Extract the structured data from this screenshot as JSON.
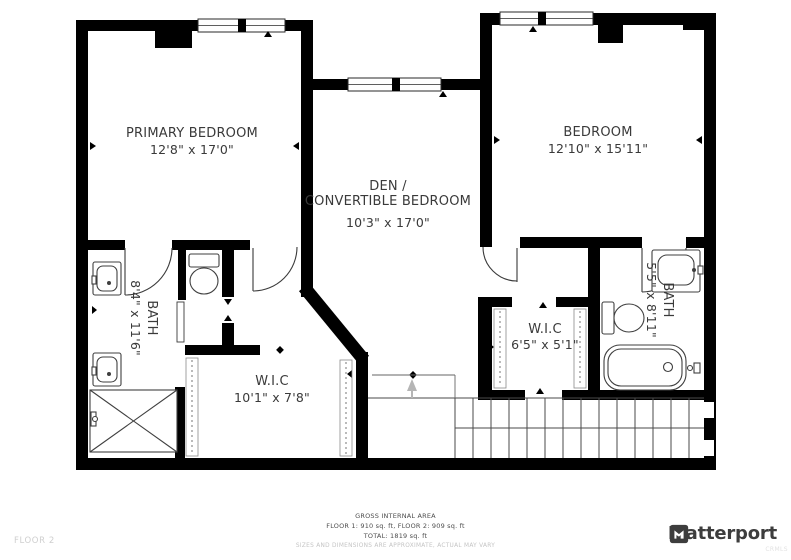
{
  "floorplan": {
    "primary_bedroom": {
      "label": "PRIMARY BEDROOM",
      "dims": "12'8\" x 17'0\""
    },
    "bedroom": {
      "label": "BEDROOM",
      "dims": "12'10\" x 15'11\""
    },
    "den": {
      "label_line1": "DEN /",
      "label_line2": "CONVERTIBLE BEDROOM",
      "dims": "10'3\" x 17'0\""
    },
    "bath_left": {
      "label": "BATH",
      "dims": "8'4\" x 11'6\""
    },
    "wic_left": {
      "label": "W.I.C",
      "dims": "10'1\" x 7'8\""
    },
    "wic_right": {
      "label": "W.I.C",
      "dims": "6'5\" x 5'1\""
    },
    "bath_right": {
      "label": "BATH",
      "dims": "5'5\" x 8'11\""
    }
  },
  "footer": {
    "gross_title": "GROSS INTERNAL AREA",
    "floors_line": "FLOOR 1: 910 sq. ft, FLOOR 2: 909 sq. ft",
    "total_line": "TOTAL: 1819 sq. ft",
    "disclaimer": "SIZES AND DIMENSIONS ARE APPROXIMATE, ACTUAL MAY VARY",
    "floor_label": "FLOOR 2",
    "brand": "Matterport",
    "watermark": "CRMLS"
  },
  "colors": {
    "wall": "#000000",
    "fixture_line": "#3f3f3f",
    "label_text": "#3a3a3a",
    "footer_text": "#4d4d4d",
    "muted_text": "#c4c4c4",
    "brand_text": "#3d3d3d"
  }
}
